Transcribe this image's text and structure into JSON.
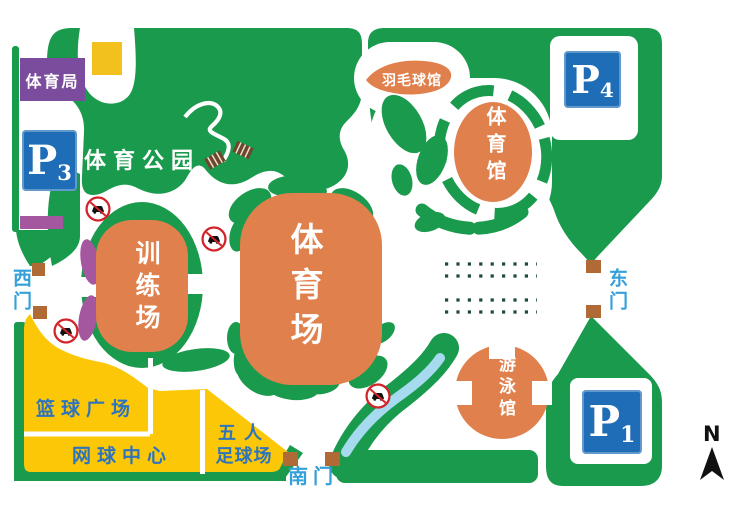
{
  "map": {
    "park_name": "体育公园",
    "facilities": {
      "sports_bureau": "体育局",
      "badminton_hall": "羽毛球馆",
      "gymnasium": "体育馆",
      "training_ground": "训练场",
      "stadium": "体育场",
      "swimming_hall": "游泳馆",
      "basketball_plaza": "篮球广场",
      "tennis_center": "网球中心",
      "futsal_field_line1": "五人",
      "futsal_field_line2": "足球场"
    },
    "gates": {
      "west": "西门",
      "east": "东门",
      "south": "南门"
    },
    "parking": {
      "p1": {
        "letter": "P",
        "num": "1"
      },
      "p3": {
        "letter": "P",
        "num": "3"
      },
      "p4": {
        "letter": "P",
        "num": "4"
      }
    },
    "compass": {
      "north_label": "N"
    },
    "colors": {
      "green": "#1a9a4d",
      "orange": "#e0804c",
      "yellow": "#fcc707",
      "yellow_square": "#f2c11d",
      "purple_box": "#7b4b9d",
      "purple_bar": "#a4569f",
      "parking_blue": "#1e6db6",
      "gate_text_blue": "#35a0d9",
      "field_text_blue": "#2e74bd",
      "stream_blue": "#a6daee",
      "gate_marker_brown": "#b06a35",
      "no_car_red": "#d2232a"
    }
  }
}
